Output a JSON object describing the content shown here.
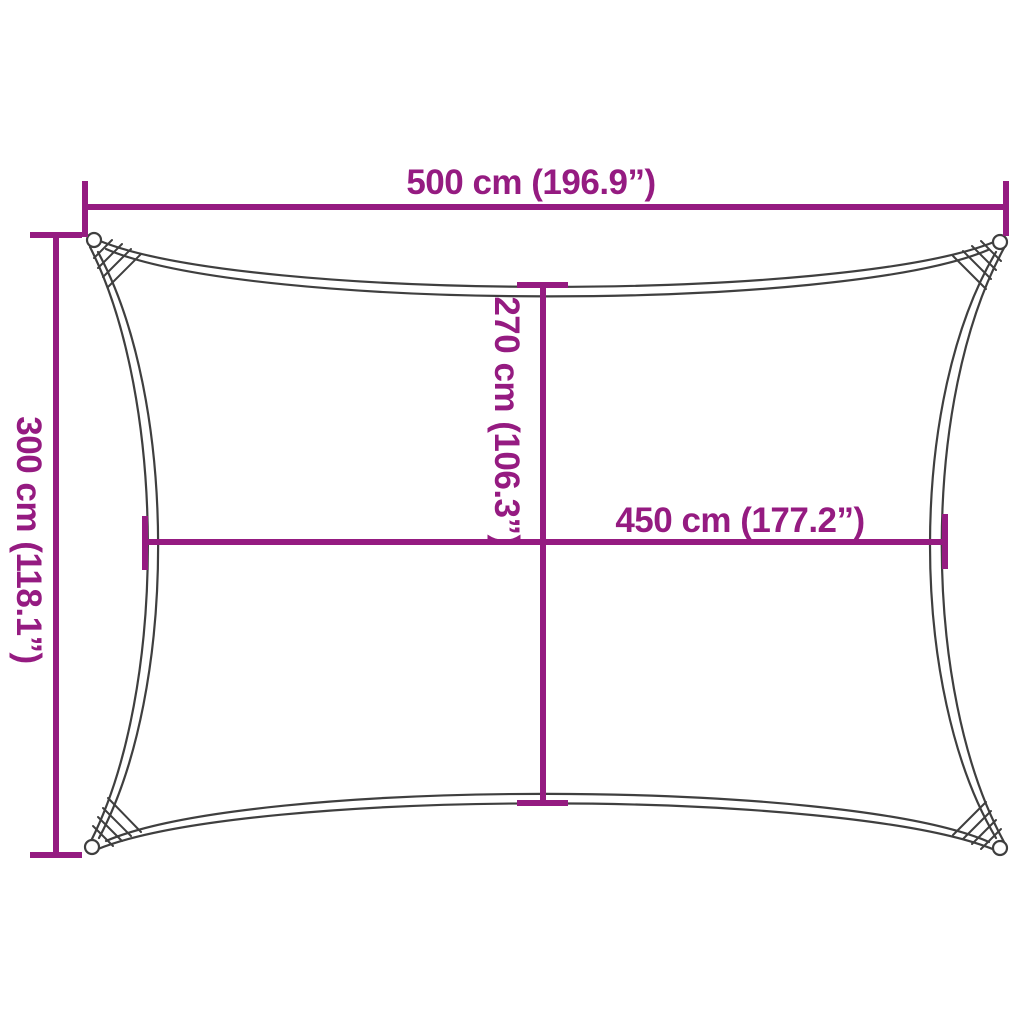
{
  "diagram": {
    "figure": "rectangular-shade-sail-outline-with-concave-edges-corner-rings-and-stitched-corners",
    "labels": {
      "width_top": "500 cm (196.9”)",
      "height_left": "300 cm (118.1”)",
      "height_inner": "270 cm (106.3”)",
      "width_inner": "450 cm (177.2”)"
    },
    "colors": {
      "dimension_line": "#951b81",
      "outline": "#3f3f3f",
      "background": "#ffffff"
    }
  }
}
